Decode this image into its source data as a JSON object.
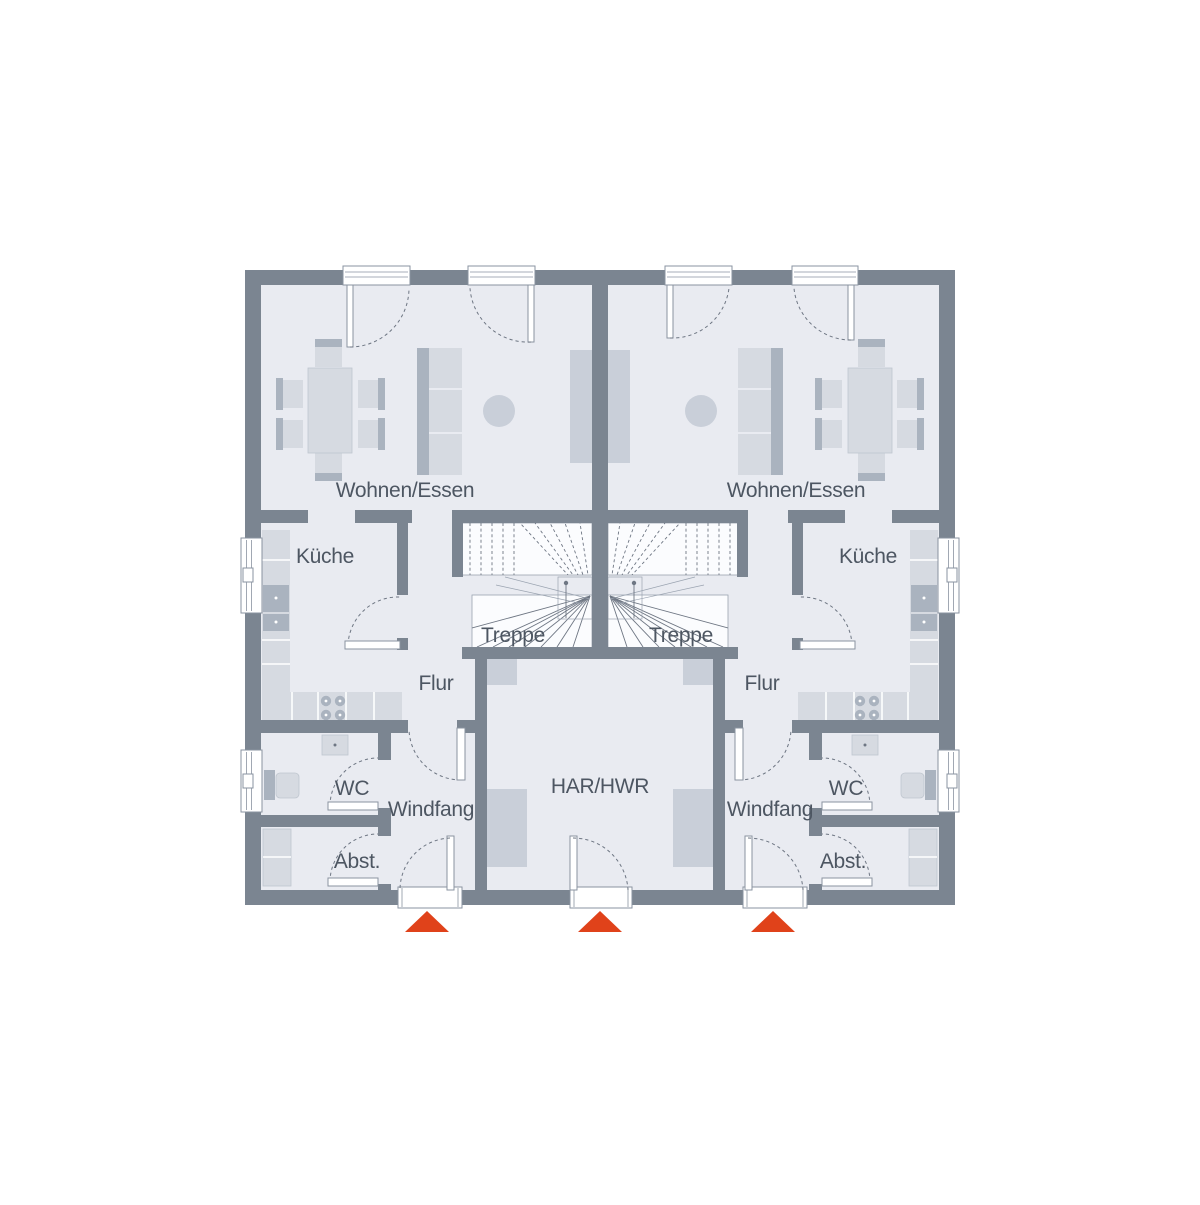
{
  "colors": {
    "wall": "#7b8591",
    "room": "#e9ebf1",
    "stair": "#fbfcfe",
    "stair-stroke": "#9aa3b0",
    "line": "#6e7683",
    "frame": "#8a93a0",
    "furn-light": "#d6dae1",
    "furn-mid": "#c9cfd9",
    "furn-dark": "#aab3bf",
    "furn-stroke": "#bfc6cf",
    "text": "#4d5662",
    "accent": "#e0421a"
  },
  "rooms": {
    "left": {
      "living": "Wohnen/Essen",
      "kitchen": "Küche",
      "stairs": "Treppe",
      "hallway": "Flur",
      "wc": "WC",
      "vestibule": "Windfang",
      "storage": "Abst."
    },
    "right": {
      "living": "Wohnen/Essen",
      "kitchen": "Küche",
      "stairs": "Treppe",
      "hallway": "Flur",
      "wc": "WC",
      "vestibule": "Windfang",
      "storage": "Abst."
    },
    "shared": {
      "utility": "HAR/HWR"
    }
  }
}
